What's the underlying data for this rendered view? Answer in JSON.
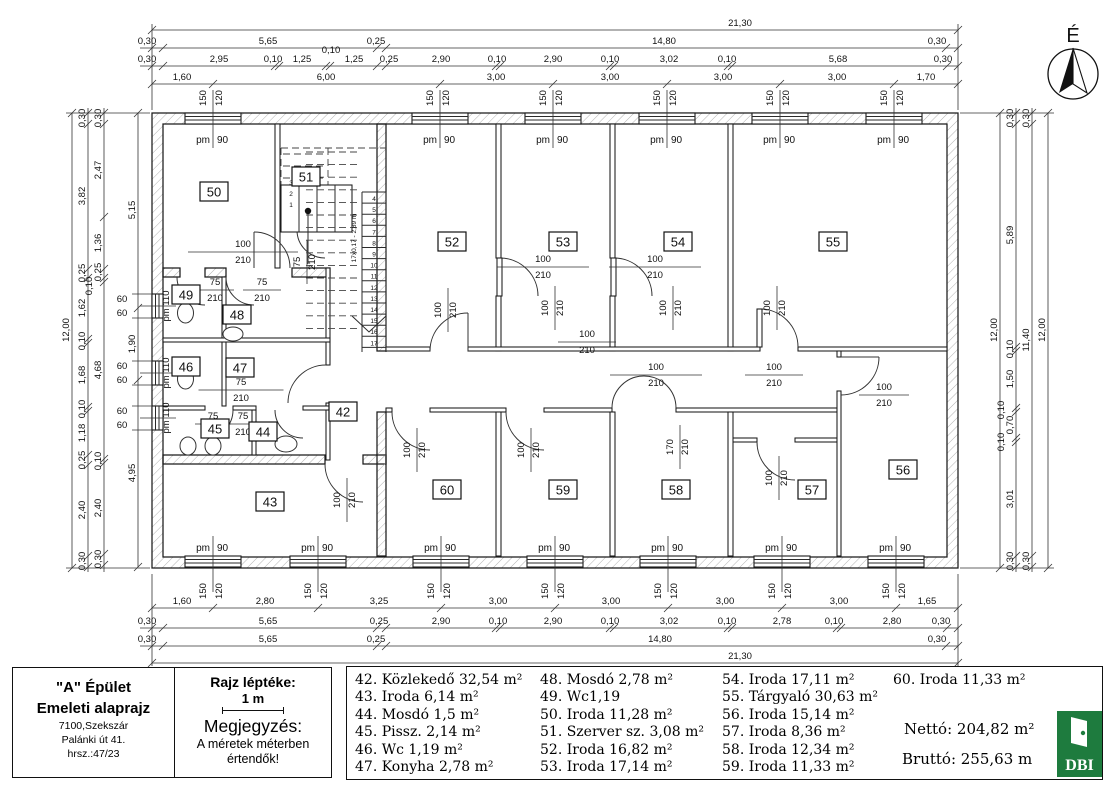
{
  "north_label": "É",
  "title_block": {
    "building": "\"A\" Épület",
    "drawing": "Emeleti alaprajz",
    "address_line1": "7100,Szekszár",
    "address_line2": "Palánki út 41.",
    "address_line3": "hrsz.:47/23",
    "scale_title": "Rajz léptéke:",
    "scale_value": "1 m",
    "note_title": "Megjegyzés:",
    "note_line1": "A méretek méterben",
    "note_line2": "értendők!"
  },
  "legend": {
    "columns": [
      [
        "42. Közlekedő 32,54 m²",
        "43. Iroda 6,14 m²",
        "44. Mosdó 1,5 m²",
        "45. Pissz. 2,14 m²",
        "46. Wc 1,19 m²",
        "47. Konyha 2,78 m²"
      ],
      [
        "48. Mosdó 2,78 m²",
        "49. Wc1,19",
        "50. Iroda 11,28 m²",
        "51. Szerver sz. 3,08 m²",
        "52. Iroda 16,82 m²",
        "53. Iroda 17,14 m²"
      ],
      [
        "54. Iroda 17,11 m²",
        "55. Tárgyaló 30,63 m²",
        "56. Iroda 15,14 m²",
        "57. Iroda 8,36 m²",
        "58. Iroda 12,34 m²",
        "59. Iroda 11,33 m²"
      ],
      [
        "60. Iroda 11,33 m²"
      ]
    ],
    "netto": "Nettó: 204,82 m²",
    "brutto": "Bruttó: 255,63 m",
    "logo_text": "DBI",
    "logo_color": "#1e7b3e"
  },
  "plan": {
    "rooms": [
      {
        "id": "42",
        "x": 343,
        "y": 412
      },
      {
        "id": "43",
        "x": 270,
        "y": 502
      },
      {
        "id": "44",
        "x": 263,
        "y": 432
      },
      {
        "id": "45",
        "x": 215,
        "y": 429
      },
      {
        "id": "46",
        "x": 186,
        "y": 367
      },
      {
        "id": "47",
        "x": 240,
        "y": 368
      },
      {
        "id": "48",
        "x": 237,
        "y": 315
      },
      {
        "id": "49",
        "x": 186,
        "y": 295
      },
      {
        "id": "50",
        "x": 214,
        "y": 192
      },
      {
        "id": "51",
        "x": 306,
        "y": 177
      },
      {
        "id": "52",
        "x": 452,
        "y": 242
      },
      {
        "id": "53",
        "x": 563,
        "y": 242
      },
      {
        "id": "54",
        "x": 678,
        "y": 242
      },
      {
        "id": "55",
        "x": 833,
        "y": 242
      },
      {
        "id": "56",
        "x": 903,
        "y": 470
      },
      {
        "id": "57",
        "x": 812,
        "y": 490
      },
      {
        "id": "58",
        "x": 676,
        "y": 490
      },
      {
        "id": "59",
        "x": 563,
        "y": 490
      },
      {
        "id": "60",
        "x": 447,
        "y": 490
      }
    ],
    "windows": {
      "label": "pm 90",
      "label_left": "pm 110",
      "spec_w": "150",
      "spec_h": "120",
      "left_d": "60",
      "top": [
        213,
        440,
        553,
        667,
        780,
        894
      ],
      "bottom": [
        213,
        318,
        441,
        555,
        668,
        782,
        896
      ],
      "left": [
        306,
        373,
        418
      ]
    },
    "door_labels": [
      {
        "w": "100",
        "h": "210",
        "x": 243,
        "y": 250,
        "rot": false,
        "lw": 110
      },
      {
        "w": "75",
        "h": "210",
        "x": 300,
        "y": 262,
        "rot": true
      },
      {
        "w": "75",
        "h": "210",
        "x": 215,
        "y": 288,
        "rot": false,
        "lw": 38
      },
      {
        "w": "75",
        "h": "210",
        "x": 262,
        "y": 288,
        "rot": false,
        "lw": 38
      },
      {
        "w": "75",
        "h": "210",
        "x": 241,
        "y": 388,
        "rot": false,
        "lw": 85
      },
      {
        "w": "75",
        "h": "210",
        "x": 213,
        "y": 422,
        "rot": false,
        "lw": 36
      },
      {
        "w": "75",
        "h": "210",
        "x": 243,
        "y": 422,
        "rot": false,
        "lw": 36
      },
      {
        "w": "100",
        "h": "210",
        "x": 441,
        "y": 310,
        "rot": true
      },
      {
        "w": "100",
        "h": "210",
        "x": 548,
        "y": 308,
        "rot": true
      },
      {
        "w": "100",
        "h": "210",
        "x": 666,
        "y": 308,
        "rot": true
      },
      {
        "w": "100",
        "h": "210",
        "x": 770,
        "y": 308,
        "rot": true
      },
      {
        "w": "100",
        "h": "210",
        "x": 543,
        "y": 265,
        "rot": false,
        "lw": 92
      },
      {
        "w": "100",
        "h": "210",
        "x": 655,
        "y": 265,
        "rot": false,
        "lw": 92
      },
      {
        "w": "100",
        "h": "210",
        "x": 656,
        "y": 373,
        "rot": false,
        "lw": 92
      },
      {
        "w": "100",
        "h": "210",
        "x": 774,
        "y": 373,
        "rot": false,
        "lw": 58
      },
      {
        "w": "100",
        "h": "210",
        "x": 884,
        "y": 393,
        "rot": false,
        "lw": 50
      },
      {
        "w": "100",
        "h": "210",
        "x": 587,
        "y": 340,
        "rot": false,
        "lw": 58
      },
      {
        "w": "100",
        "h": "210",
        "x": 410,
        "y": 450,
        "rot": true
      },
      {
        "w": "100",
        "h": "210",
        "x": 524,
        "y": 450,
        "rot": true
      },
      {
        "w": "170",
        "h": "210",
        "x": 673,
        "y": 447,
        "rot": true
      },
      {
        "w": "100",
        "h": "210",
        "x": 772,
        "y": 478,
        "rot": true
      },
      {
        "w": "100",
        "h": "210",
        "x": 340,
        "y": 500,
        "rot": true
      }
    ],
    "dims": [
      {
        "dir": "h",
        "pos": 30,
        "a": 152,
        "b": 958,
        "ticks": [
          152,
          958
        ],
        "labels": [
          {
            "p": 740,
            "t": "21,30"
          }
        ]
      },
      {
        "dir": "h",
        "pos": 48,
        "a": 140,
        "b": 958,
        "ticks": [
          152,
          163,
          377,
          386,
          946,
          958
        ],
        "labels": [
          {
            "p": 147,
            "t": "0,30"
          },
          {
            "p": 268,
            "t": "5,65"
          },
          {
            "p": 376,
            "t": "0,25"
          },
          {
            "p": 664,
            "t": "14,80"
          },
          {
            "p": 937,
            "t": "0,30"
          }
        ]
      },
      {
        "dir": "h",
        "pos": 66,
        "a": 140,
        "b": 958,
        "ticks": [
          152,
          163,
          275,
          279,
          326,
          330,
          377,
          386,
          496,
          500,
          610,
          614,
          728,
          732,
          947,
          958
        ],
        "labels": [
          {
            "p": 147,
            "t": "0,30"
          },
          {
            "p": 219,
            "t": "2,95"
          },
          {
            "p": 273,
            "t": "0,10"
          },
          {
            "p": 302,
            "t": "1,25"
          },
          {
            "p": 331,
            "t": "0,10",
            "o": -9
          },
          {
            "p": 354,
            "t": "1,25"
          },
          {
            "p": 389,
            "t": "0,25"
          },
          {
            "p": 441,
            "t": "2,90"
          },
          {
            "p": 497,
            "t": "0,10"
          },
          {
            "p": 553,
            "t": "2,90"
          },
          {
            "p": 610,
            "t": "0,10"
          },
          {
            "p": 669,
            "t": "3,02"
          },
          {
            "p": 727,
            "t": "0,10"
          },
          {
            "p": 838,
            "t": "5,68"
          },
          {
            "p": 943,
            "t": "0,30"
          }
        ]
      },
      {
        "dir": "h",
        "pos": 84,
        "a": 152,
        "b": 958,
        "ticks": [
          152,
          213,
          440,
          553,
          667,
          780,
          894,
          958
        ],
        "labels": [
          {
            "p": 182,
            "t": "1,60"
          },
          {
            "p": 326,
            "t": "6,00"
          },
          {
            "p": 496,
            "t": "3,00"
          },
          {
            "p": 610,
            "t": "3,00"
          },
          {
            "p": 723,
            "t": "3,00"
          },
          {
            "p": 837,
            "t": "3,00"
          },
          {
            "p": 926,
            "t": "1,70"
          }
        ]
      },
      {
        "dir": "h",
        "pos": 608,
        "a": 152,
        "b": 958,
        "ticks": [
          152,
          213,
          318,
          441,
          555,
          668,
          782,
          896,
          958
        ],
        "labels": [
          {
            "p": 182,
            "t": "1,60"
          },
          {
            "p": 265,
            "t": "2,80"
          },
          {
            "p": 379,
            "t": "3,25"
          },
          {
            "p": 498,
            "t": "3,00"
          },
          {
            "p": 611,
            "t": "3,00"
          },
          {
            "p": 725,
            "t": "3,00"
          },
          {
            "p": 839,
            "t": "3,00"
          },
          {
            "p": 927,
            "t": "1,65"
          }
        ]
      },
      {
        "dir": "h",
        "pos": 628,
        "a": 140,
        "b": 958,
        "ticks": [
          152,
          163,
          377,
          386,
          496,
          500,
          610,
          614,
          728,
          732,
          837,
          841,
          947,
          958
        ],
        "labels": [
          {
            "p": 147,
            "t": "0,30"
          },
          {
            "p": 268,
            "t": "5,65"
          },
          {
            "p": 379,
            "t": "0,25"
          },
          {
            "p": 441,
            "t": "2,90"
          },
          {
            "p": 498,
            "t": "0,10"
          },
          {
            "p": 553,
            "t": "2,90"
          },
          {
            "p": 610,
            "t": "0,10"
          },
          {
            "p": 669,
            "t": "3,02"
          },
          {
            "p": 727,
            "t": "0,10"
          },
          {
            "p": 782,
            "t": "2,78"
          },
          {
            "p": 834,
            "t": "0,10"
          },
          {
            "p": 892,
            "t": "2,80"
          },
          {
            "p": 941,
            "t": "0,30"
          }
        ]
      },
      {
        "dir": "h",
        "pos": 646,
        "a": 140,
        "b": 958,
        "ticks": [
          152,
          163,
          377,
          386,
          946,
          958
        ],
        "labels": [
          {
            "p": 147,
            "t": "0,30"
          },
          {
            "p": 268,
            "t": "5,65"
          },
          {
            "p": 376,
            "t": "0,25"
          },
          {
            "p": 660,
            "t": "14,80"
          },
          {
            "p": 937,
            "t": "0,30"
          }
        ]
      },
      {
        "dir": "h",
        "pos": 663,
        "a": 152,
        "b": 958,
        "ticks": [
          152,
          958
        ],
        "labels": [
          {
            "p": 740,
            "t": "21,30"
          }
        ]
      },
      {
        "dir": "v",
        "pos": 72,
        "a": 113,
        "b": 568,
        "ticks": [
          113,
          568
        ],
        "labels": [
          {
            "p": 330,
            "t": "12,00"
          }
        ]
      },
      {
        "dir": "v",
        "pos": 88,
        "a": 108,
        "b": 572,
        "ticks": [
          113,
          124,
          269,
          278,
          339,
          343,
          407,
          411,
          455,
          465,
          556,
          567
        ],
        "labels": [
          {
            "p": 118,
            "t": "0,30"
          },
          {
            "p": 196,
            "t": "3,82"
          },
          {
            "p": 273,
            "t": "0,25"
          },
          {
            "p": 308,
            "t": "1,62"
          },
          {
            "p": 341,
            "t": "0,10"
          },
          {
            "p": 375,
            "t": "1,68"
          },
          {
            "p": 409,
            "t": "0,10"
          },
          {
            "p": 433,
            "t": "1,18"
          },
          {
            "p": 460,
            "t": "0,25"
          },
          {
            "p": 510,
            "t": "2,40"
          },
          {
            "p": 561,
            "t": "0,30"
          }
        ]
      },
      {
        "dir": "v",
        "pos": 104,
        "a": 108,
        "b": 572,
        "ticks": [
          113,
          124,
          217,
          269,
          278,
          282,
          459,
          463,
          554,
          565
        ],
        "labels": [
          {
            "p": 118,
            "t": "0,30"
          },
          {
            "p": 170,
            "t": "2,47"
          },
          {
            "p": 243,
            "t": "1,36"
          },
          {
            "p": 272,
            "t": "0,25"
          },
          {
            "p": 286,
            "t": "0,10",
            "o": -9
          },
          {
            "p": 370,
            "t": "4,68"
          },
          {
            "p": 461,
            "t": "0,10"
          },
          {
            "p": 508,
            "t": "2,40"
          },
          {
            "p": 559,
            "t": "0,30"
          }
        ]
      },
      {
        "dir": "v",
        "pos": 138,
        "a": 113,
        "b": 567,
        "ticks": [
          113,
          308,
          380,
          567
        ],
        "labels": [
          {
            "p": 210,
            "t": "5,15"
          },
          {
            "p": 344,
            "t": "1,90"
          },
          {
            "p": 473,
            "t": "4,95"
          }
        ]
      },
      {
        "dir": "v",
        "pos": 1000,
        "a": 113,
        "b": 568,
        "ticks": [
          113,
          568
        ],
        "labels": [
          {
            "p": 330,
            "t": "12,00"
          }
        ]
      },
      {
        "dir": "v",
        "pos": 1016,
        "a": 108,
        "b": 572,
        "ticks": [
          113,
          124,
          347,
          351,
          408,
          412,
          438,
          442,
          556,
          567
        ],
        "labels": [
          {
            "p": 118,
            "t": "0,30"
          },
          {
            "p": 235,
            "t": "5,89"
          },
          {
            "p": 349,
            "t": "0,10"
          },
          {
            "p": 379,
            "t": "1,50"
          },
          {
            "p": 410,
            "t": "0,10",
            "o": -9
          },
          {
            "p": 425,
            "t": "0,70"
          },
          {
            "p": 442,
            "t": "0,10",
            "o": -9
          },
          {
            "p": 499,
            "t": "3,01"
          },
          {
            "p": 561,
            "t": "0,30"
          }
        ]
      },
      {
        "dir": "v",
        "pos": 1032,
        "a": 108,
        "b": 572,
        "ticks": [
          113,
          124,
          556,
          567
        ],
        "labels": [
          {
            "p": 118,
            "t": "0,30"
          },
          {
            "p": 340,
            "t": "11,40"
          },
          {
            "p": 561,
            "t": "0,30"
          }
        ]
      },
      {
        "dir": "v",
        "pos": 1048,
        "a": 113,
        "b": 568,
        "ticks": [
          113,
          568
        ],
        "labels": [
          {
            "p": 330,
            "t": "12,00"
          }
        ]
      }
    ],
    "stair": {
      "flight1": [
        "3",
        "2",
        "1"
      ],
      "numbers": [
        "4",
        "5",
        "6",
        "7",
        "8",
        "9",
        "10",
        "11",
        "12",
        "13",
        "14",
        "15",
        "16",
        "17"
      ],
      "note": "17x0,17 - 2,89 m"
    }
  }
}
